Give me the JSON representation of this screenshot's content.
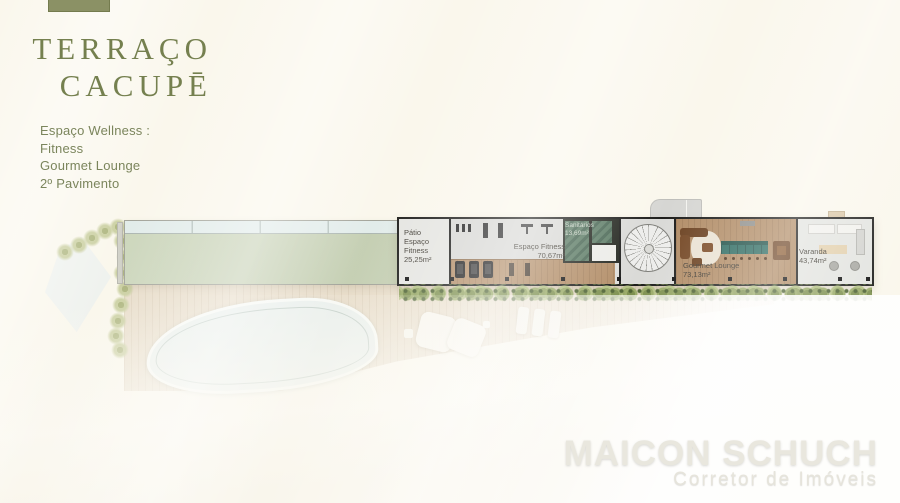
{
  "brand": {
    "title_line1": "TERRAÇO",
    "title_line2": "CACUPĒ"
  },
  "info": {
    "lines": [
      "Espaço Wellness :",
      "Fitness",
      "Gourmet Lounge",
      "2º Pavimento"
    ]
  },
  "floorplan": {
    "rooms": [
      {
        "name": "Pátio Espaço Fitness",
        "area": "25,25m²"
      },
      {
        "name": "Espaço Fitness",
        "area": "70,67m²"
      },
      {
        "name": "Sanitários",
        "area": "13,69m²"
      },
      {
        "name": "Gourmet Lounge",
        "area": "73,13m²"
      },
      {
        "name": "Varanda",
        "area": "43,74m²"
      }
    ]
  },
  "watermark": {
    "name": "MAICON SCHUCH",
    "role": "Corretor de Imóveis"
  },
  "colors": {
    "brand_green": "#75804f",
    "tab_green": "#8b9165",
    "roof_green": "#ccd5ba",
    "deck_tan": "#e8ddca",
    "wood_floor": "#b28d67",
    "bar_teal": "#2c6a60",
    "hedge_green": "#7e9150",
    "background_cream": "#faf7ec"
  }
}
